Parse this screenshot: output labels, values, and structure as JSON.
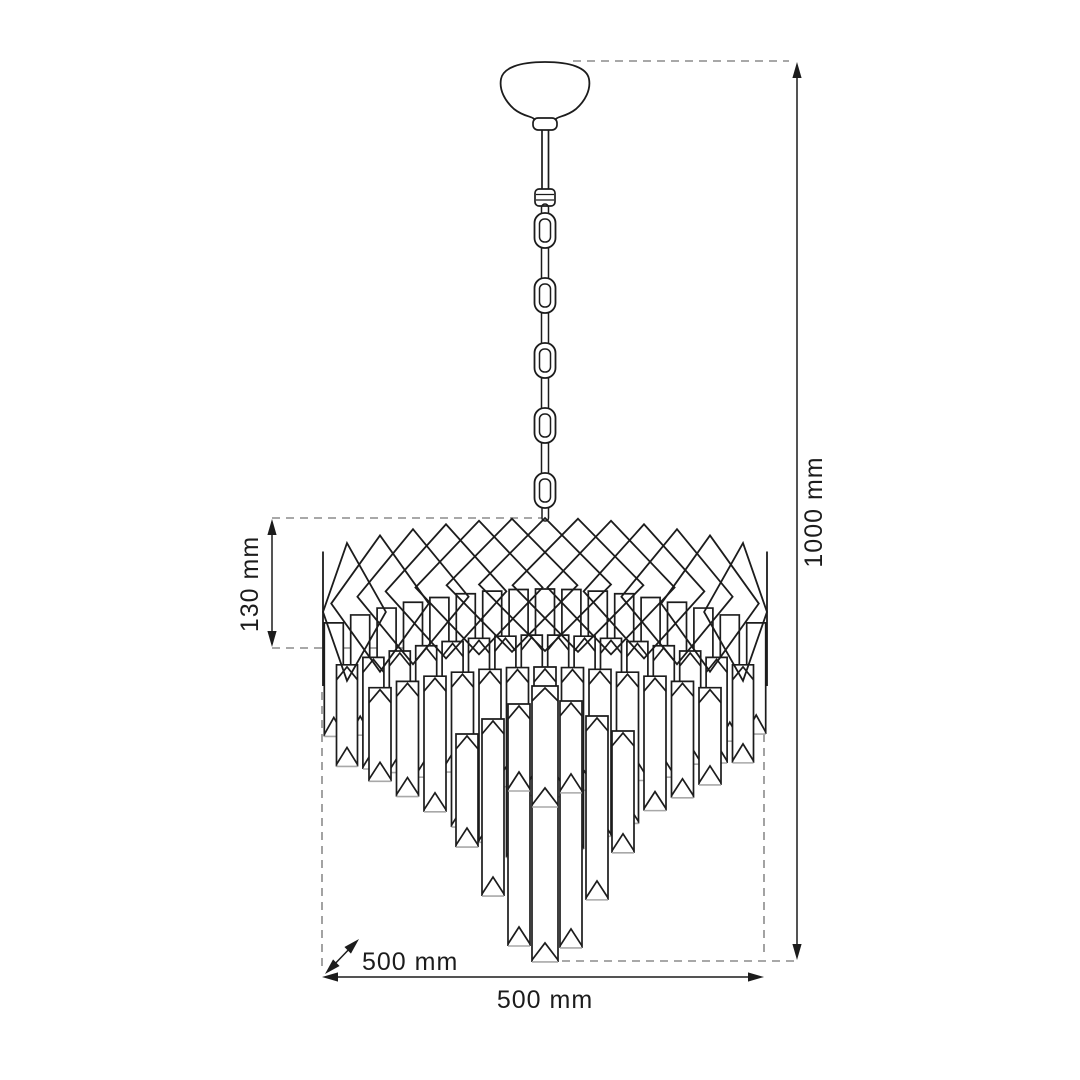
{
  "page": {
    "background": "#ffffff"
  },
  "diagram": {
    "title": "Chandelier dimension drawing",
    "subject": "crystal pendant chandelier with canopy, chain, diamond lattice crown and cascading crystal prisms",
    "style": {
      "line_color": "#1c1c1c",
      "dim_line_color": "#1c1c1c",
      "dash_color": "#8c8c8c",
      "shade_color": "#a8a8a8",
      "text_color": "#1c1c1c"
    },
    "dimensions": {
      "total_height": {
        "label": "1000 mm",
        "value": 1000,
        "unit": "mm",
        "orientation": "vertical",
        "position": "right"
      },
      "crown_height": {
        "label": "130 mm",
        "value": 130,
        "unit": "mm",
        "orientation": "vertical",
        "position": "left"
      },
      "depth": {
        "label": "500 mm",
        "value": 500,
        "unit": "mm",
        "orientation": "diagonal",
        "position": "bottom-left"
      },
      "width": {
        "label": "500 mm",
        "value": 500,
        "unit": "mm",
        "orientation": "horizontal",
        "position": "bottom"
      }
    },
    "parts": [
      "ceiling-canopy",
      "suspension-chain",
      "crystal-crown-band",
      "crystal-cascade"
    ]
  }
}
